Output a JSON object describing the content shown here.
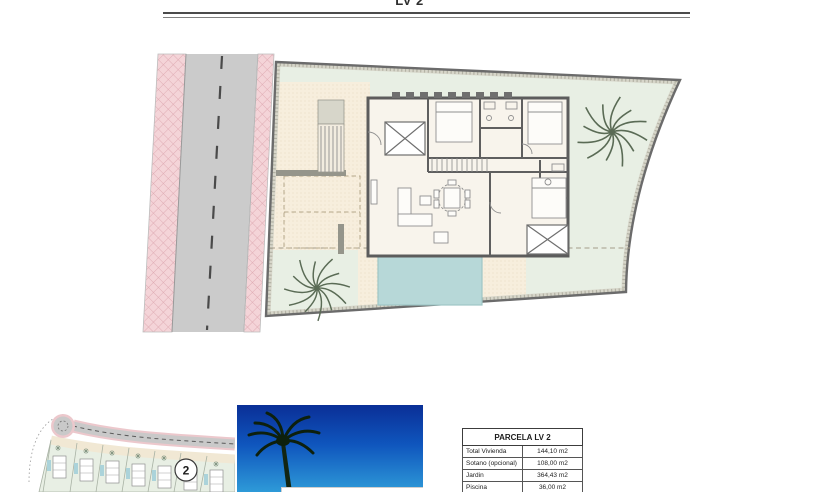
{
  "header": {
    "title": "LV 2"
  },
  "site_plan": {
    "content": "ground-floor site plan of parcel LV 2 with road, driveway, villa floor plan, pool, garden and two palm trees"
  },
  "mini_map": {
    "plot_badge": "2"
  },
  "table": {
    "title": "PARCELA LV 2",
    "rows": [
      {
        "label": "Total Vivienda",
        "value": "144,10 m2"
      },
      {
        "label": "Sotano (opcional)",
        "value": "108,00 m2"
      },
      {
        "label": "Jardin",
        "value": "364,43 m2"
      },
      {
        "label": "Piscina",
        "value": "36,00 m2"
      }
    ]
  },
  "colors": {
    "road": "#cbcbcb",
    "sidewalk_pink": "#f4d4d8",
    "garden_green": "#e8efe4",
    "terrace_beige": "#f7eedd",
    "pool_blue": "#b7d8d8",
    "wall_gray": "#5c5c5c",
    "sky_top": "#0a2f96",
    "sky_bottom": "#2e9ad8"
  }
}
